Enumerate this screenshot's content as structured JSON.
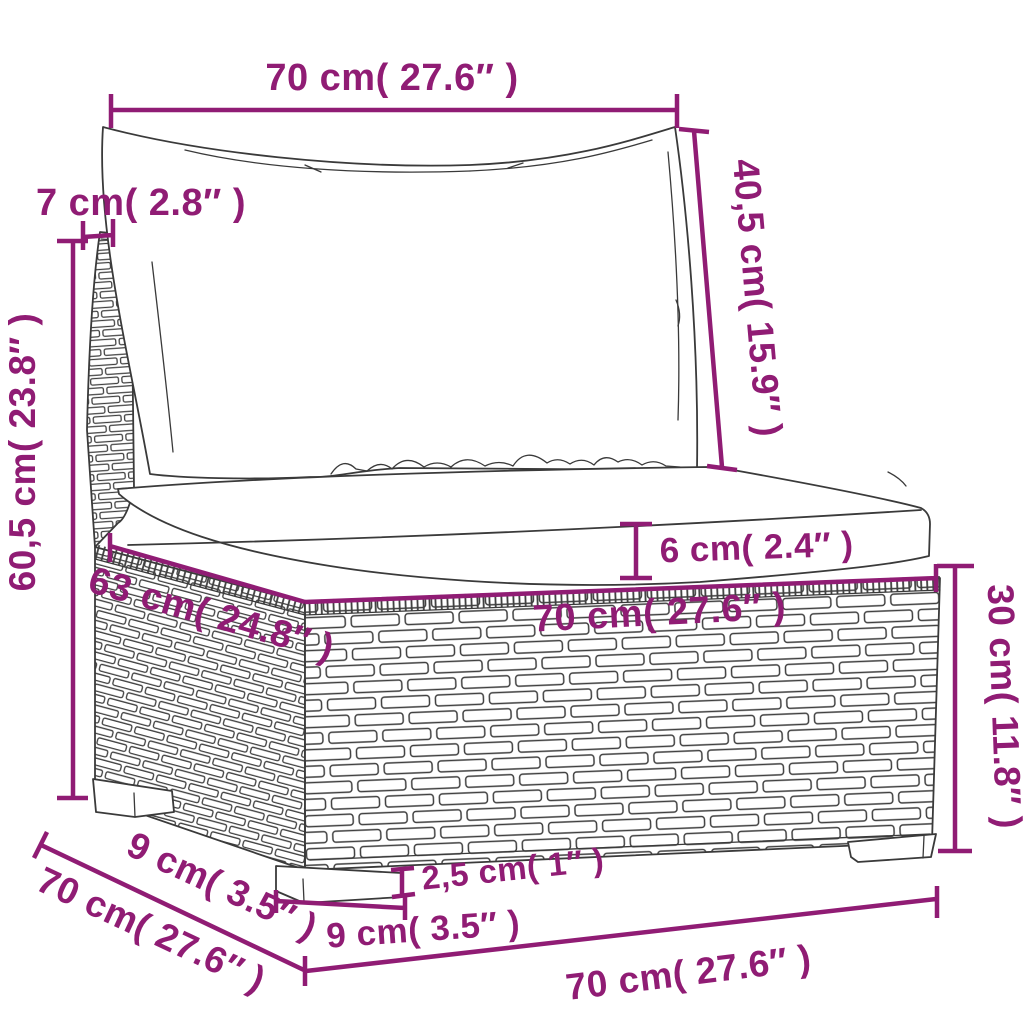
{
  "diagram": {
    "title": "poly rattan sofa section dimension drawing",
    "accent_color": "#901c74",
    "outline_color": "#3a3a3a",
    "background_color": "#ffffff",
    "labels": {
      "top_width": "70 cm( 27.6″ )",
      "back_height": "40,5 cm( 15.9″ )",
      "back_panel_width": "7 cm( 2.8″ )",
      "total_height": "60,5 cm( 23.8″ )",
      "seat_depth": "63 cm( 24.8″ )",
      "seat_width": "70 cm( 27.6″ )",
      "cushion_thickness": "6 cm( 2.4″ )",
      "base_height": "30 cm( 11.8″ )",
      "leg_height": "2,5 cm( 1″ )",
      "leg_width": "9 cm( 3.5″ )",
      "side_leg_depth": "9 cm( 3.5″ )",
      "bottom_side_depth": "70 cm( 27.6″ )",
      "bottom_front_width": "70 cm( 27.6″ )"
    }
  }
}
